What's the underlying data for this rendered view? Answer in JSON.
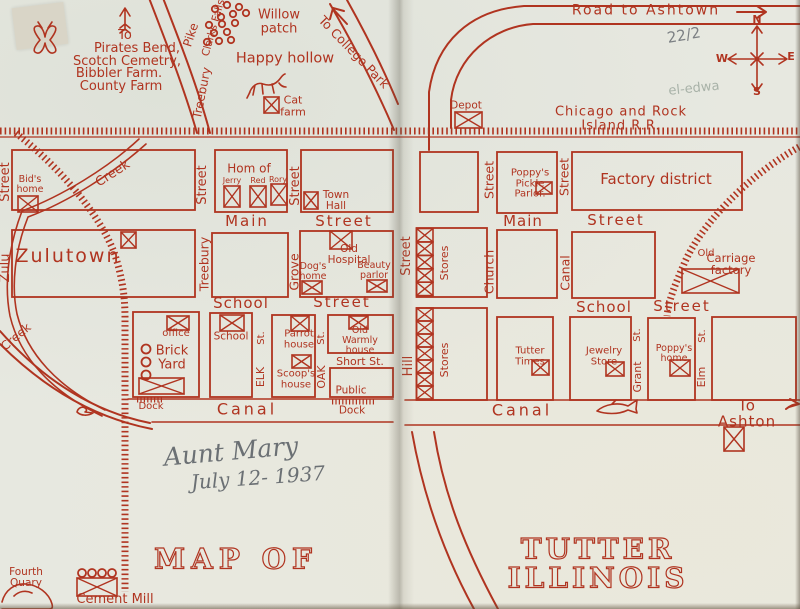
{
  "title": "Map of Tutter Illinois (book endpaper map)",
  "colors": {
    "ink": "#b03420",
    "paper": "#e7e8e0",
    "pencil": "#7c8084",
    "pencil_light": "#a8b2a8",
    "handwriting": "#6b7074"
  },
  "labels": [
    {
      "n": "to-word",
      "t": "To",
      "x": 125,
      "y": 36,
      "fs": 13
    },
    {
      "n": "pirates-bend",
      "t": "Pirates Bend,",
      "x": 137,
      "y": 49,
      "fs": 13
    },
    {
      "n": "scotch-cemetry",
      "t": "Scotch Cemetry,",
      "x": 127,
      "y": 61.5,
      "fs": 13
    },
    {
      "n": "bibbler-farm",
      "t": "Bibbler Farm.",
      "x": 119,
      "y": 73.5,
      "fs": 13
    },
    {
      "n": "county-farm",
      "t": "County Farm",
      "x": 121,
      "y": 86.5,
      "fs": 13
    },
    {
      "n": "treebury-pike-pike",
      "t": "Pike",
      "x": 191,
      "y": 35,
      "fs": 12,
      "rot": -72
    },
    {
      "n": "treebury-pike-treebury",
      "t": "Treebury",
      "x": 202,
      "y": 93,
      "fs": 12,
      "rot": -79
    },
    {
      "n": "clarks-falls",
      "t": "Clarks Falls",
      "x": 214,
      "y": 28,
      "fs": 10.5,
      "rot": -74
    },
    {
      "n": "willow-patch",
      "t": "Willow\npatch",
      "x": 279,
      "y": 22,
      "fs": 13
    },
    {
      "n": "to-college-park",
      "t": "To College Park",
      "x": 354,
      "y": 52,
      "fs": 12.5,
      "rot": 46
    },
    {
      "n": "happy-hollow",
      "t": "Happy hollow",
      "x": 285,
      "y": 59,
      "fs": 14.5
    },
    {
      "n": "cat-farm",
      "t": "Cat\nfarm",
      "x": 293,
      "y": 106,
      "fs": 11
    },
    {
      "n": "zulu-street-street",
      "t": "Street",
      "x": 6,
      "y": 182,
      "fs": 13,
      "rot": -90
    },
    {
      "n": "zulu-street-zulu",
      "t": "Zulu",
      "x": 6,
      "y": 268,
      "fs": 13,
      "rot": -90
    },
    {
      "n": "bids-home",
      "t": "Bid's\nhome",
      "x": 30,
      "y": 185,
      "fs": 9.5
    },
    {
      "n": "creek-upper",
      "t": "Creek",
      "x": 113,
      "y": 174,
      "fs": 13,
      "rot": -33
    },
    {
      "n": "zulutown",
      "t": "Zulutown",
      "x": 68,
      "y": 257,
      "fs": 19,
      "ls": 2
    },
    {
      "n": "treebury-street-street",
      "t": "Street",
      "x": 203,
      "y": 185,
      "fs": 13,
      "rot": -90
    },
    {
      "n": "treebury-street-treebury",
      "t": "Treebury",
      "x": 204,
      "y": 264,
      "fs": 12.5,
      "rot": -90
    },
    {
      "n": "grove-street-street",
      "t": "Street",
      "x": 296,
      "y": 186,
      "fs": 13,
      "rot": -90
    },
    {
      "n": "grove-street-grove",
      "t": "Grove",
      "x": 294,
      "y": 272,
      "fs": 12.5,
      "rot": -90
    },
    {
      "n": "hom-of",
      "t": "Hom of",
      "x": 249,
      "y": 169,
      "fs": 12
    },
    {
      "n": "jerry",
      "t": "Jerry",
      "x": 232,
      "y": 181,
      "fs": 8
    },
    {
      "n": "red",
      "t": "Red",
      "x": 258,
      "y": 181,
      "fs": 8
    },
    {
      "n": "rory",
      "t": "Rory",
      "x": 278,
      "y": 180,
      "fs": 8
    },
    {
      "n": "town-hall",
      "t": "Town\nHall",
      "x": 336,
      "y": 201,
      "fs": 10.5
    },
    {
      "n": "main-street-left-main",
      "t": "Main",
      "x": 247,
      "y": 222,
      "fs": 15,
      "ls": 2
    },
    {
      "n": "main-street-left-street",
      "t": "Street",
      "x": 344,
      "y": 222,
      "fs": 15,
      "ls": 2
    },
    {
      "n": "old-hospital",
      "t": "Old\nHospital",
      "x": 349,
      "y": 255,
      "fs": 10.5
    },
    {
      "n": "dogs-home",
      "t": "Dog's\nhome",
      "x": 313,
      "y": 272,
      "fs": 9.5
    },
    {
      "n": "beauty-parlor",
      "t": "Beauty\nparlor",
      "x": 374,
      "y": 271,
      "fs": 9.5
    },
    {
      "n": "school-street-left-school",
      "t": "School",
      "x": 241,
      "y": 304,
      "fs": 15,
      "ls": 1
    },
    {
      "n": "school-street-left-street",
      "t": "Street",
      "x": 342,
      "y": 303,
      "fs": 15,
      "ls": 2
    },
    {
      "n": "office",
      "t": "office",
      "x": 176,
      "y": 334,
      "fs": 10
    },
    {
      "n": "brick-yard",
      "t": "Brick\nYard",
      "x": 172,
      "y": 358,
      "fs": 13
    },
    {
      "n": "dock-brickyard",
      "t": "Dock",
      "x": 151,
      "y": 407,
      "fs": 10
    },
    {
      "n": "school-house",
      "t": "School",
      "x": 231,
      "y": 337,
      "fs": 10.5
    },
    {
      "n": "elk-st-st",
      "t": "St.",
      "x": 262,
      "y": 338,
      "fs": 10,
      "rot": -90
    },
    {
      "n": "elk-st-elk",
      "t": "ELK",
      "x": 261,
      "y": 377,
      "fs": 11,
      "rot": -90
    },
    {
      "n": "parrot-house",
      "t": "Parrot\nhouse",
      "x": 299,
      "y": 340,
      "fs": 10
    },
    {
      "n": "scoops-house",
      "t": "Scoop's\nhouse",
      "x": 296,
      "y": 380,
      "fs": 10
    },
    {
      "n": "oak-st-st",
      "t": "St.",
      "x": 322,
      "y": 338,
      "fs": 10,
      "rot": -90
    },
    {
      "n": "oak-st-oak",
      "t": "OAK",
      "x": 322,
      "y": 377,
      "fs": 11,
      "rot": -90
    },
    {
      "n": "old-warmly-house",
      "t": "Old\nWarmly\nhouse",
      "x": 360,
      "y": 341,
      "fs": 9.5
    },
    {
      "n": "short-st",
      "t": "Short St.",
      "x": 360,
      "y": 362,
      "fs": 11
    },
    {
      "n": "public-dock-public",
      "t": "Public",
      "x": 351,
      "y": 391,
      "fs": 10.5
    },
    {
      "n": "public-dock-dock",
      "t": "Dock",
      "x": 352,
      "y": 411,
      "fs": 10.5
    },
    {
      "n": "canal-left",
      "t": "Canal",
      "x": 247,
      "y": 410,
      "fs": 16,
      "ls": 3
    },
    {
      "n": "creek-lower",
      "t": "Creek",
      "x": 16,
      "y": 337,
      "fs": 12,
      "rot": -40
    },
    {
      "n": "fourth-quary",
      "t": "Fourth\nQuary",
      "x": 26,
      "y": 578,
      "fs": 10.5
    },
    {
      "n": "cement-mill",
      "t": "Cement Mill",
      "x": 115,
      "y": 600,
      "fs": 13
    },
    {
      "n": "map-of-title",
      "t": "MAP OF",
      "x": 236,
      "y": 559,
      "fs": 28,
      "cls": "outline-title",
      "ls": 6
    },
    {
      "n": "aunt-mary-handwriting",
      "t": "Aunt Mary",
      "x": 231,
      "y": 452,
      "fs": 25,
      "cls": "pencil-script",
      "rot": -5
    },
    {
      "n": "july-1937-handwriting",
      "t": "July 12- 1937",
      "x": 258,
      "y": 478,
      "fs": 20,
      "cls": "pencil-script",
      "rot": -4
    },
    {
      "n": "road-to-ashtown",
      "t": "Road to Ashtown",
      "x": 646,
      "y": 11,
      "fs": 14,
      "ls": 2
    },
    {
      "n": "pencil-fraction",
      "t": "22/2",
      "x": 684,
      "y": 36,
      "fs": 15,
      "cls": "pencil",
      "rot": -10
    },
    {
      "n": "pencil-eledwa",
      "t": "el-edwa",
      "x": 694,
      "y": 89,
      "fs": 13,
      "cls": "pencil-lt",
      "rot": -6
    },
    {
      "n": "compass-n",
      "t": "N",
      "x": 757,
      "y": 20,
      "fs": 11,
      "cls": "bold"
    },
    {
      "n": "compass-w",
      "t": "W",
      "x": 722,
      "y": 59,
      "fs": 11,
      "cls": "bold"
    },
    {
      "n": "compass-e",
      "t": "E",
      "x": 791,
      "y": 57,
      "fs": 11,
      "cls": "bold"
    },
    {
      "n": "compass-s",
      "t": "S",
      "x": 757,
      "y": 92,
      "fs": 11,
      "cls": "bold"
    },
    {
      "n": "depot",
      "t": "Depot",
      "x": 466,
      "y": 106,
      "fs": 10.5
    },
    {
      "n": "railroad-name",
      "t": "Chicago and Rock Island R.R.",
      "x": 621,
      "y": 119,
      "fs": 13,
      "ls": 1
    },
    {
      "n": "church-street-street",
      "t": "Street",
      "x": 489,
      "y": 180,
      "fs": 12.5,
      "rot": -90
    },
    {
      "n": "poppys-pickle-parlor",
      "t": "Poppy's\nPickle\nParlor.",
      "x": 530,
      "y": 184,
      "fs": 10
    },
    {
      "n": "canal-street-street",
      "t": "Street",
      "x": 564,
      "y": 177,
      "fs": 12.5,
      "rot": -90
    },
    {
      "n": "factory-district",
      "t": "Factory district",
      "x": 656,
      "y": 180,
      "fs": 15
    },
    {
      "n": "main-street-right-main",
      "t": "Main",
      "x": 523,
      "y": 222,
      "fs": 15,
      "ls": 1
    },
    {
      "n": "main-street-right-street",
      "t": "Street",
      "x": 616,
      "y": 221,
      "fs": 15,
      "ls": 2
    },
    {
      "n": "stores-upper",
      "t": "Stores",
      "x": 445,
      "y": 263,
      "fs": 11,
      "rot": -90
    },
    {
      "n": "church-street-church",
      "t": "Church",
      "x": 489,
      "y": 272,
      "fs": 12.5,
      "rot": -90
    },
    {
      "n": "canal-street-canal",
      "t": "Canal",
      "x": 565,
      "y": 273,
      "fs": 12.5,
      "rot": -90
    },
    {
      "n": "hill-street-street",
      "t": "Street",
      "x": 407,
      "y": 256,
      "fs": 13,
      "rot": -90
    },
    {
      "n": "hill-street-hill",
      "t": "Hill",
      "x": 409,
      "y": 366,
      "fs": 13,
      "rot": -90
    },
    {
      "n": "old-carriage-old",
      "t": "Old",
      "x": 706,
      "y": 254,
      "fs": 10
    },
    {
      "n": "old-carriage-factory",
      "t": "Carriage factory",
      "x": 731,
      "y": 264,
      "fs": 11.5
    },
    {
      "n": "school-street-right-school",
      "t": "School",
      "x": 604,
      "y": 308,
      "fs": 15,
      "ls": 1
    },
    {
      "n": "school-street-right-street",
      "t": "Street",
      "x": 682,
      "y": 307,
      "fs": 15,
      "ls": 2
    },
    {
      "n": "stores-lower",
      "t": "Stores",
      "x": 445,
      "y": 360,
      "fs": 11,
      "rot": -90
    },
    {
      "n": "tutter-times",
      "t": "Tutter\nTimes",
      "x": 530,
      "y": 357,
      "fs": 10
    },
    {
      "n": "jewelry-store",
      "t": "Jewelry\nStore",
      "x": 604,
      "y": 357,
      "fs": 10
    },
    {
      "n": "grant-st-st",
      "t": "St.",
      "x": 638,
      "y": 335,
      "fs": 10,
      "rot": -90
    },
    {
      "n": "grant-st-grant",
      "t": "Grant",
      "x": 638,
      "y": 377,
      "fs": 11,
      "rot": -90
    },
    {
      "n": "poppys-home",
      "t": "Poppy's\nhome",
      "x": 674,
      "y": 354,
      "fs": 9.5
    },
    {
      "n": "elm-st-st",
      "t": "St.",
      "x": 703,
      "y": 336,
      "fs": 10,
      "rot": -90
    },
    {
      "n": "elm-st-elm",
      "t": "Elm",
      "x": 702,
      "y": 377,
      "fs": 11,
      "rot": -90
    },
    {
      "n": "canal-right",
      "t": "Canal",
      "x": 522,
      "y": 411,
      "fs": 16,
      "ls": 3
    },
    {
      "n": "to-ashton",
      "t": "To Ashton",
      "x": 747,
      "y": 414,
      "fs": 15,
      "ls": 1
    },
    {
      "n": "tutter-illinois-title",
      "t": "TUTTER ILLINOIS",
      "x": 598,
      "y": 564,
      "fs": 28,
      "cls": "outline-title",
      "ls": 4
    }
  ],
  "xboxes": [
    {
      "n": "cat-farm-box",
      "x": 264,
      "y": 97,
      "w": 15,
      "h": 16
    },
    {
      "n": "bids-home-box",
      "x": 18,
      "y": 196,
      "w": 20,
      "h": 16
    },
    {
      "n": "zulutown-box",
      "x": 121,
      "y": 232,
      "w": 15,
      "h": 16
    },
    {
      "n": "jerry-box",
      "x": 224,
      "y": 186,
      "w": 16,
      "h": 21
    },
    {
      "n": "red-box",
      "x": 250,
      "y": 186,
      "w": 16,
      "h": 21
    },
    {
      "n": "rory-box",
      "x": 271,
      "y": 184,
      "w": 16,
      "h": 21
    },
    {
      "n": "town-hall-box",
      "x": 304,
      "y": 192,
      "w": 14,
      "h": 17
    },
    {
      "n": "old-hospital-box",
      "x": 330,
      "y": 231,
      "w": 22,
      "h": 18
    },
    {
      "n": "dogs-home-box",
      "x": 302,
      "y": 281,
      "w": 20,
      "h": 13
    },
    {
      "n": "beauty-parlor-box",
      "x": 367,
      "y": 280,
      "w": 20,
      "h": 12
    },
    {
      "n": "office-box",
      "x": 167,
      "y": 316,
      "w": 22,
      "h": 14
    },
    {
      "n": "school-box",
      "x": 220,
      "y": 315,
      "w": 24,
      "h": 16
    },
    {
      "n": "parrot-house-box",
      "x": 291,
      "y": 316,
      "w": 18,
      "h": 15
    },
    {
      "n": "scoops-house-box",
      "x": 292,
      "y": 355,
      "w": 19,
      "h": 13
    },
    {
      "n": "old-warmly-box",
      "x": 349,
      "y": 316,
      "w": 19,
      "h": 13
    },
    {
      "n": "brick-kiln-box",
      "x": 139,
      "y": 378,
      "w": 45,
      "h": 16
    },
    {
      "n": "cement-mill-box",
      "x": 77,
      "y": 578,
      "w": 40,
      "h": 18
    },
    {
      "n": "old-carriage-box",
      "x": 682,
      "y": 269,
      "w": 57,
      "h": 24
    },
    {
      "n": "depot-box",
      "x": 455,
      "y": 112,
      "w": 27,
      "h": 16
    },
    {
      "n": "poppys-pickle-box",
      "x": 536,
      "y": 182,
      "w": 16,
      "h": 12
    },
    {
      "n": "tutter-times-box",
      "x": 532,
      "y": 360,
      "w": 17,
      "h": 15
    },
    {
      "n": "jewelry-store-box",
      "x": 606,
      "y": 362,
      "w": 18,
      "h": 14
    },
    {
      "n": "poppys-home-box",
      "x": 670,
      "y": 360,
      "w": 20,
      "h": 16
    },
    {
      "n": "ashton-box",
      "x": 724,
      "y": 427,
      "w": 20,
      "h": 24
    },
    {
      "n": "stores-upper-box-1",
      "x": 416.5,
      "y": 228.5,
      "w": 16.5,
      "h": 13.4
    },
    {
      "n": "stores-upper-box-2",
      "x": 416.5,
      "y": 242,
      "w": 16.5,
      "h": 13.4
    },
    {
      "n": "stores-upper-box-3",
      "x": 416.5,
      "y": 255.4,
      "w": 16.5,
      "h": 13.4
    },
    {
      "n": "stores-upper-box-4",
      "x": 416.5,
      "y": 268.8,
      "w": 16.5,
      "h": 13.4
    },
    {
      "n": "stores-upper-box-5",
      "x": 416.5,
      "y": 282.2,
      "w": 16.5,
      "h": 13.4
    },
    {
      "n": "stores-lower-box-1",
      "x": 416.5,
      "y": 308,
      "w": 16.5,
      "h": 13
    },
    {
      "n": "stores-lower-box-2",
      "x": 416.5,
      "y": 321,
      "w": 16.5,
      "h": 13
    },
    {
      "n": "stores-lower-box-3",
      "x": 416.5,
      "y": 334,
      "w": 16.5,
      "h": 13
    },
    {
      "n": "stores-lower-box-4",
      "x": 416.5,
      "y": 347,
      "w": 16.5,
      "h": 13
    },
    {
      "n": "stores-lower-box-5",
      "x": 416.5,
      "y": 360,
      "w": 16.5,
      "h": 13
    },
    {
      "n": "stores-lower-box-6",
      "x": 416.5,
      "y": 373,
      "w": 16.5,
      "h": 13
    },
    {
      "n": "stores-lower-box-7",
      "x": 416.5,
      "y": 386,
      "w": 16.5,
      "h": 13
    }
  ],
  "circle_groups": [
    {
      "n": "willow-patch-circles",
      "r": 3.2,
      "pts": [
        [
          215,
          9
        ],
        [
          227,
          5
        ],
        [
          239,
          7
        ],
        [
          221,
          17
        ],
        [
          233,
          14
        ],
        [
          246,
          13
        ],
        [
          209,
          25
        ],
        [
          222,
          24
        ],
        [
          235,
          23
        ],
        [
          214,
          33
        ],
        [
          227,
          32
        ],
        [
          207,
          42
        ],
        [
          219,
          41
        ],
        [
          231,
          40
        ]
      ]
    },
    {
      "n": "brick-yard-circles",
      "r": 4.5,
      "pts": [
        [
          146,
          349
        ],
        [
          146,
          362
        ],
        [
          146,
          375
        ]
      ]
    },
    {
      "n": "cement-mill-circles",
      "r": 4,
      "pts": [
        [
          82,
          573
        ],
        [
          92,
          573
        ],
        [
          102,
          573
        ],
        [
          112,
          573
        ]
      ]
    }
  ]
}
